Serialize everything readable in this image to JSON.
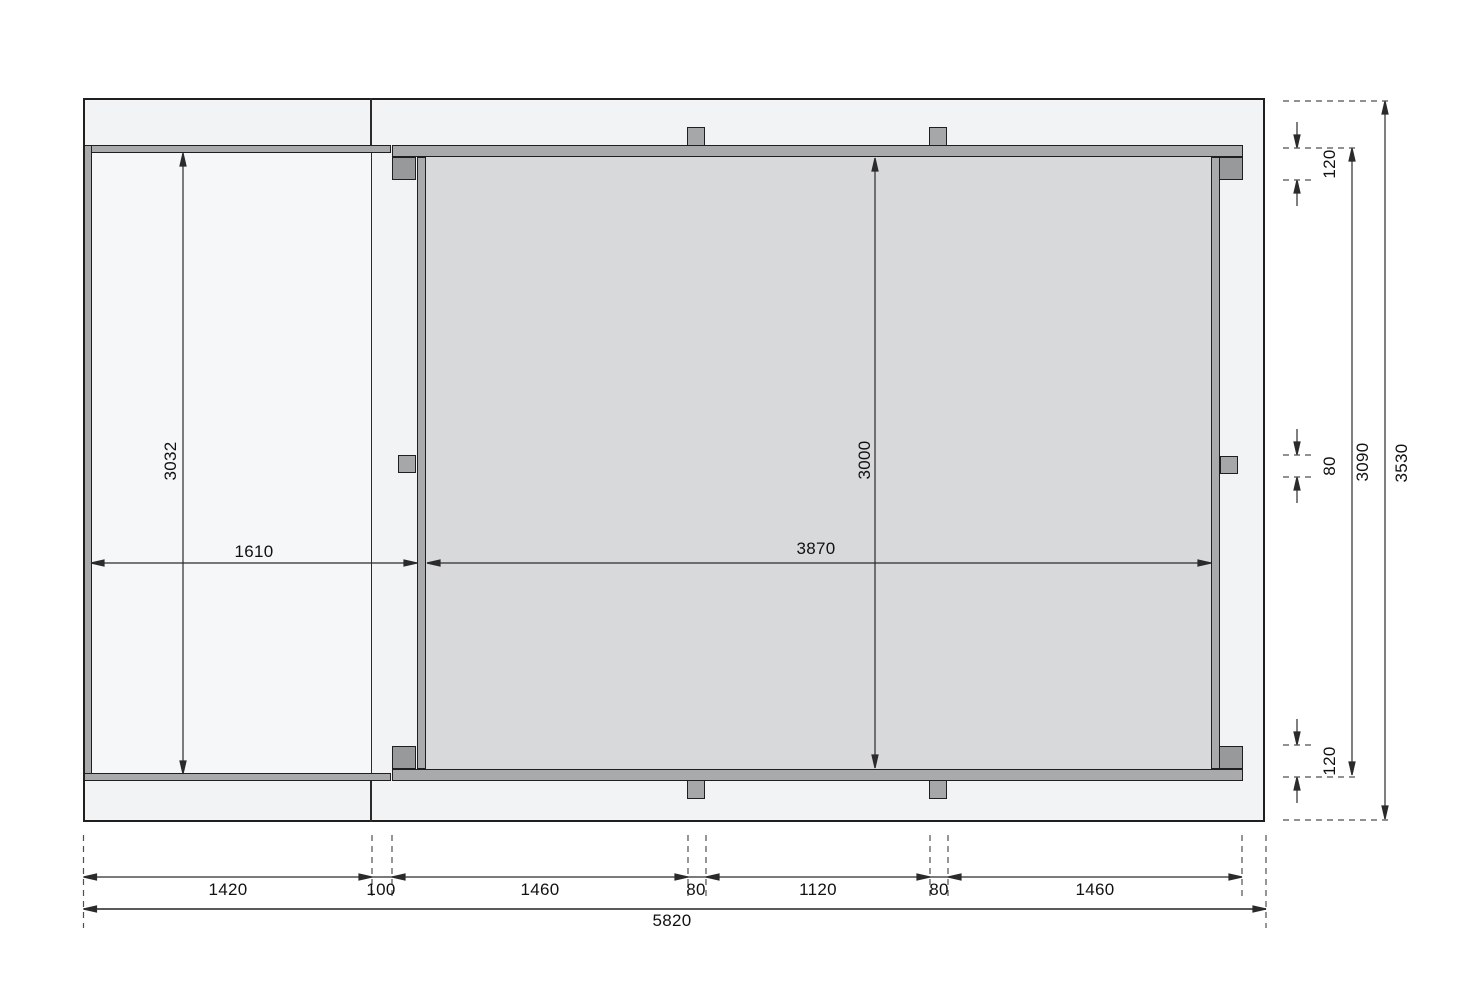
{
  "drawing": {
    "title": "floor frame dimension drawing",
    "units": "mm",
    "colors": {
      "outer_fill": "#f2f3f4",
      "annex_fill": "#f6f7f8",
      "room_fill": "#d8d9da",
      "wall_fill": "#a9aaab",
      "post_fill": "#98999a",
      "outline": "#1f1f1f"
    }
  },
  "dimensions": {
    "annex": {
      "width": "1610",
      "height": "3032"
    },
    "room": {
      "width": "3870",
      "height": "3000"
    },
    "right_chain": {
      "top": "120",
      "middle": "80",
      "bottom": "120",
      "inner_total": "3090",
      "outer_total": "3530"
    },
    "bottom_chain": {
      "segments": [
        "1420",
        "100",
        "1460",
        "80",
        "1120",
        "80",
        "1460"
      ],
      "total": "5820"
    }
  }
}
